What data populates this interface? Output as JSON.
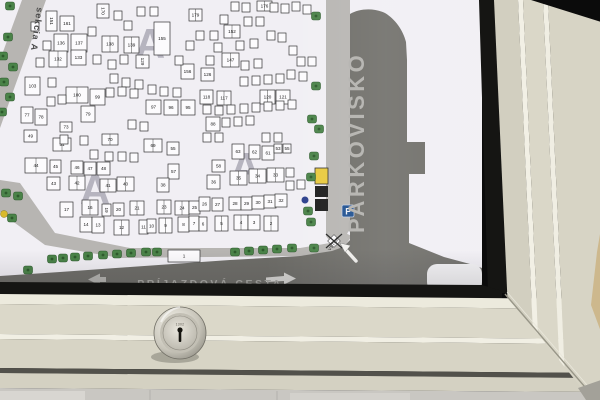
{
  "board": {
    "section_label": "sekcia A",
    "area_letter": "A",
    "parking_label": "PARKOVISKO",
    "access_road_label": "PRÍJAZDOVÁ CESTA",
    "entrance_label": "VSTUP",
    "parking_sign_letter": "P",
    "watermarks": [
      [
        150,
        58
      ],
      [
        95,
        204
      ],
      [
        245,
        182
      ]
    ],
    "plots": [
      [
        "151",
        46,
        11,
        11,
        20,
        0,
        90
      ],
      [
        "161",
        60,
        16,
        14,
        15,
        0,
        0
      ],
      [
        "136",
        54,
        34,
        14,
        18,
        0,
        0
      ],
      [
        "137",
        71,
        34,
        16,
        18,
        0,
        0
      ],
      [
        "132",
        49,
        51,
        18,
        16,
        1,
        0
      ],
      [
        "133",
        71,
        50,
        15,
        15,
        0,
        0
      ],
      [
        "170",
        97,
        4,
        12,
        14,
        0,
        90
      ],
      [
        "138",
        102,
        36,
        16,
        16,
        1,
        0
      ],
      [
        "139",
        124,
        37,
        15,
        16,
        1,
        0
      ],
      [
        "155",
        154,
        22,
        16,
        33,
        0,
        0
      ],
      [
        "129",
        136,
        55,
        13,
        13,
        0,
        90
      ],
      [
        "179",
        189,
        9,
        13,
        12,
        1,
        0
      ],
      [
        "176",
        257,
        1,
        15,
        10,
        1,
        0
      ],
      [
        "152",
        224,
        25,
        16,
        13,
        1,
        0
      ],
      [
        "147",
        222,
        53,
        17,
        14,
        1,
        0
      ],
      [
        "156",
        181,
        64,
        13,
        15,
        0,
        0
      ],
      [
        "126",
        201,
        68,
        13,
        13,
        0,
        0
      ],
      [
        "103",
        25,
        77,
        15,
        18,
        0,
        0
      ],
      [
        "100",
        66,
        87,
        22,
        16,
        1,
        0
      ],
      [
        "99",
        90,
        89,
        15,
        16,
        0,
        0
      ],
      [
        "97",
        146,
        100,
        15,
        14,
        0,
        0
      ],
      [
        "96",
        164,
        100,
        14,
        15,
        0,
        0
      ],
      [
        "95",
        181,
        100,
        14,
        15,
        0,
        0
      ],
      [
        "118",
        200,
        90,
        13,
        14,
        0,
        0
      ],
      [
        "117",
        217,
        91,
        14,
        14,
        1,
        0
      ],
      [
        "120",
        260,
        90,
        15,
        14,
        1,
        0
      ],
      [
        "121",
        276,
        90,
        14,
        14,
        0,
        0
      ],
      [
        "88",
        206,
        117,
        14,
        14,
        0,
        0
      ],
      [
        "77",
        21,
        107,
        12,
        16,
        0,
        0
      ],
      [
        "78",
        35,
        109,
        12,
        16,
        0,
        0
      ],
      [
        "79",
        81,
        106,
        14,
        16,
        0,
        0
      ],
      [
        "73",
        60,
        122,
        12,
        10,
        0,
        0
      ],
      [
        "49",
        24,
        130,
        13,
        12,
        0,
        0
      ],
      [
        "51",
        53,
        138,
        18,
        13,
        1,
        0
      ],
      [
        "70",
        102,
        134,
        16,
        11,
        1,
        0
      ],
      [
        "69",
        144,
        139,
        18,
        13,
        1,
        0
      ],
      [
        "55",
        167,
        142,
        12,
        13,
        0,
        0
      ],
      [
        "44",
        25,
        158,
        22,
        15,
        1,
        0
      ],
      [
        "45",
        50,
        160,
        11,
        13,
        0,
        0
      ],
      [
        "46",
        71,
        161,
        12,
        13,
        0,
        0
      ],
      [
        "47",
        84,
        162,
        12,
        13,
        0,
        0
      ],
      [
        "48",
        97,
        162,
        13,
        13,
        0,
        0
      ],
      [
        "43",
        47,
        177,
        13,
        13,
        0,
        0
      ],
      [
        "42",
        69,
        176,
        16,
        14,
        1,
        0
      ],
      [
        "41",
        100,
        179,
        16,
        13,
        1,
        0
      ],
      [
        "40",
        117,
        177,
        17,
        14,
        1,
        0
      ],
      [
        "57",
        168,
        164,
        11,
        15,
        0,
        0
      ],
      [
        "38",
        157,
        178,
        12,
        14,
        0,
        0
      ],
      [
        "17",
        60,
        202,
        13,
        15,
        0,
        0
      ],
      [
        "16",
        82,
        200,
        16,
        15,
        1,
        0
      ],
      [
        "19",
        102,
        204,
        9,
        12,
        0,
        90
      ],
      [
        "20",
        113,
        203,
        11,
        13,
        0,
        0
      ],
      [
        "21",
        130,
        201,
        14,
        14,
        1,
        0
      ],
      [
        "23",
        157,
        200,
        14,
        14,
        1,
        0
      ],
      [
        "24",
        175,
        201,
        14,
        14,
        1,
        0
      ],
      [
        "25",
        189,
        201,
        11,
        13,
        0,
        0
      ],
      [
        "14",
        80,
        217,
        12,
        15,
        0,
        0
      ],
      [
        "13",
        92,
        217,
        12,
        16,
        0,
        0
      ],
      [
        "12",
        114,
        220,
        15,
        15,
        1,
        0
      ],
      [
        "11",
        139,
        220,
        9,
        14,
        0,
        0
      ],
      [
        "10",
        147,
        219,
        9,
        14,
        0,
        0
      ],
      [
        "9",
        159,
        218,
        13,
        15,
        1,
        0
      ],
      [
        "8",
        178,
        217,
        11,
        15,
        0,
        0
      ],
      [
        "7",
        189,
        216,
        10,
        15,
        0,
        0
      ],
      [
        "6",
        199,
        217,
        8,
        14,
        0,
        0
      ],
      [
        "5",
        215,
        216,
        13,
        15,
        1,
        0
      ],
      [
        "4",
        234,
        215,
        14,
        15,
        1,
        0
      ],
      [
        "3",
        248,
        215,
        12,
        15,
        0,
        0
      ],
      [
        "2",
        264,
        216,
        14,
        15,
        1,
        0
      ],
      [
        "1",
        168,
        250,
        32,
        12,
        0,
        0
      ],
      [
        "63",
        232,
        144,
        12,
        15,
        0,
        0
      ],
      [
        "62",
        249,
        145,
        11,
        14,
        0,
        0
      ],
      [
        "61",
        262,
        146,
        12,
        14,
        0,
        0
      ],
      [
        "58",
        212,
        160,
        13,
        12,
        0,
        0
      ],
      [
        "36",
        207,
        175,
        13,
        14,
        0,
        0
      ],
      [
        "35",
        230,
        171,
        17,
        14,
        1,
        0
      ],
      [
        "34",
        249,
        169,
        17,
        14,
        1,
        0
      ],
      [
        "33",
        267,
        168,
        17,
        14,
        1,
        0
      ],
      [
        "26",
        199,
        197,
        11,
        14,
        0,
        0
      ],
      [
        "27",
        212,
        198,
        11,
        13,
        0,
        0
      ],
      [
        "28",
        229,
        197,
        12,
        13,
        0,
        0
      ],
      [
        "29",
        241,
        197,
        11,
        13,
        0,
        0
      ],
      [
        "30",
        252,
        196,
        12,
        13,
        0,
        0
      ],
      [
        "31",
        264,
        195,
        12,
        13,
        0,
        0
      ],
      [
        "32",
        275,
        194,
        12,
        13,
        0,
        0
      ],
      [
        "53",
        274,
        144,
        8,
        9,
        0,
        0
      ],
      [
        "55",
        283,
        144,
        8,
        9,
        0,
        0
      ]
    ],
    "small_plots": [
      [
        31,
        22
      ],
      [
        43,
        41
      ],
      [
        36,
        58
      ],
      [
        93,
        55
      ],
      [
        108,
        60
      ],
      [
        124,
        21
      ],
      [
        137,
        7
      ],
      [
        150,
        7
      ],
      [
        114,
        11
      ],
      [
        88,
        27
      ],
      [
        120,
        55
      ],
      [
        110,
        74
      ],
      [
        122,
        78
      ],
      [
        135,
        80
      ],
      [
        148,
        85
      ],
      [
        160,
        87
      ],
      [
        173,
        88
      ],
      [
        48,
        78
      ],
      [
        58,
        95
      ],
      [
        47,
        97
      ],
      [
        231,
        2
      ],
      [
        242,
        3
      ],
      [
        270,
        3
      ],
      [
        281,
        4
      ],
      [
        292,
        2
      ],
      [
        303,
        5
      ],
      [
        244,
        17
      ],
      [
        256,
        17
      ],
      [
        267,
        31
      ],
      [
        278,
        33
      ],
      [
        289,
        46
      ],
      [
        250,
        39
      ],
      [
        236,
        41
      ],
      [
        206,
        56
      ],
      [
        214,
        43
      ],
      [
        186,
        41
      ],
      [
        175,
        56
      ],
      [
        196,
        31
      ],
      [
        210,
        31
      ],
      [
        220,
        15
      ],
      [
        241,
        61
      ],
      [
        254,
        59
      ],
      [
        287,
        70
      ],
      [
        299,
        72
      ],
      [
        240,
        77
      ],
      [
        252,
        76
      ],
      [
        264,
        75
      ],
      [
        276,
        74
      ],
      [
        203,
        105
      ],
      [
        215,
        106
      ],
      [
        227,
        105
      ],
      [
        240,
        104
      ],
      [
        252,
        103
      ],
      [
        264,
        102
      ],
      [
        276,
        101
      ],
      [
        288,
        100
      ],
      [
        106,
        88
      ],
      [
        118,
        87
      ],
      [
        130,
        89
      ],
      [
        222,
        118
      ],
      [
        234,
        117
      ],
      [
        246,
        116
      ],
      [
        297,
        57
      ],
      [
        308,
        57
      ],
      [
        128,
        120
      ],
      [
        140,
        122
      ],
      [
        203,
        133
      ],
      [
        215,
        133
      ],
      [
        262,
        133
      ],
      [
        274,
        133
      ],
      [
        286,
        181
      ],
      [
        297,
        180
      ],
      [
        286,
        168
      ],
      [
        60,
        135
      ],
      [
        80,
        136
      ],
      [
        90,
        150
      ],
      [
        105,
        152
      ],
      [
        118,
        152
      ],
      [
        130,
        153
      ]
    ],
    "trees": [
      [
        10,
        6
      ],
      [
        8,
        37
      ],
      [
        3,
        56
      ],
      [
        13,
        67
      ],
      [
        4,
        82
      ],
      [
        10,
        97
      ],
      [
        2,
        112
      ],
      [
        6,
        193
      ],
      [
        12,
        218
      ],
      [
        316,
        16
      ],
      [
        316,
        86
      ],
      [
        312,
        119
      ],
      [
        319,
        129
      ],
      [
        314,
        156
      ],
      [
        311,
        177
      ],
      [
        308,
        211
      ],
      [
        311,
        222
      ],
      [
        314,
        248
      ],
      [
        28,
        270
      ],
      [
        52,
        259
      ],
      [
        63,
        258
      ],
      [
        75,
        257
      ],
      [
        88,
        256
      ],
      [
        103,
        255
      ],
      [
        117,
        254
      ],
      [
        131,
        253
      ],
      [
        146,
        252
      ],
      [
        157,
        252
      ],
      [
        235,
        252
      ],
      [
        249,
        251
      ],
      [
        263,
        250
      ],
      [
        277,
        249
      ],
      [
        292,
        248
      ],
      [
        18,
        196
      ]
    ],
    "markers": {
      "yellow_building": [
        315,
        168,
        13,
        16
      ],
      "black_buildings": [
        [
          315,
          186,
          13,
          11
        ],
        [
          315,
          199,
          13,
          12
        ]
      ],
      "blue_dot": [
        305,
        200
      ],
      "yellow_dot": [
        4,
        214
      ],
      "parking_sign_box": [
        342,
        205,
        12,
        12
      ],
      "gate_center": [
        334,
        241
      ]
    }
  },
  "frame": {
    "lock_code": "1302"
  },
  "colors": {
    "map_bg": "#f1eff4",
    "road_light": "#b7b5b2",
    "road_dark": "#6e6d68",
    "tree": "#4a8348",
    "tree_dark": "#2d5a2c",
    "plot_fill": "#fcfbfd",
    "plot_stroke": "#333333",
    "plot_number": "#1a1a1a",
    "frame_light": "#dcd9ca",
    "gasket": "#151513",
    "sign_blue": "#1d4f8f",
    "accent_yellow": "#e8c93e",
    "watermark_gray": "#a8a6b3",
    "label_gray": "#a7a6a2"
  }
}
